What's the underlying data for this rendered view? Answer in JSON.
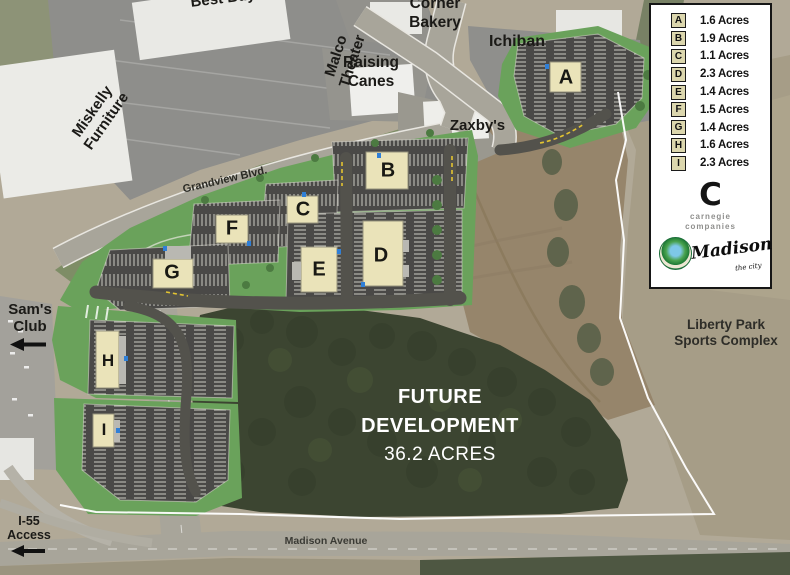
{
  "legend": {
    "items": [
      {
        "letter": "A",
        "area": "1.6 Acres"
      },
      {
        "letter": "B",
        "area": "1.9 Acres"
      },
      {
        "letter": "C",
        "area": "1.1 Acres"
      },
      {
        "letter": "D",
        "area": "2.3 Acres"
      },
      {
        "letter": "E",
        "area": "1.4 Acres"
      },
      {
        "letter": "F",
        "area": "1.5 Acres"
      },
      {
        "letter": "G",
        "area": "1.4 Acres"
      },
      {
        "letter": "H",
        "area": "1.6 Acres"
      },
      {
        "letter": "I",
        "area": "2.3 Acres"
      }
    ],
    "carnegie_monogram": "C",
    "carnegie_line1": "carnegie",
    "carnegie_line2": "companies",
    "madison_script": "Madison",
    "madison_sub": "the city"
  },
  "labels": {
    "best_buy": "Best Buy",
    "malco_line1": "Malco",
    "malco_line2": "Theater",
    "miskelly_line1": "Miskelly",
    "miskelly_line2": "Furniture",
    "corner_line1": "Corner",
    "corner_line2": "Bakery",
    "canes_line1": "Raising",
    "canes_line2": "Canes",
    "ichiban": "Ichiban",
    "zaxbys": "Zaxby's",
    "grandview": "Grandview Blvd.",
    "madison_avenue": "Madison Avenue",
    "sams_line1": "Sam's",
    "sams_line2": "Club",
    "i55_line1": "I-55",
    "i55_line2": "Access",
    "liberty_line1": "Liberty Park",
    "liberty_line2": "Sports Complex",
    "future_line1": "FUTURE",
    "future_line2": "DEVELOPMENT",
    "future_line3": "36.2 ACRES"
  },
  "colors": {
    "site_green": "#6aa25b",
    "site_parking": "#4a4947",
    "building_fill": "#eae3b9",
    "boundary": "#ffffff",
    "accessible_blue": "#2f7fd6",
    "legend_chip": "#dcd7ae"
  }
}
